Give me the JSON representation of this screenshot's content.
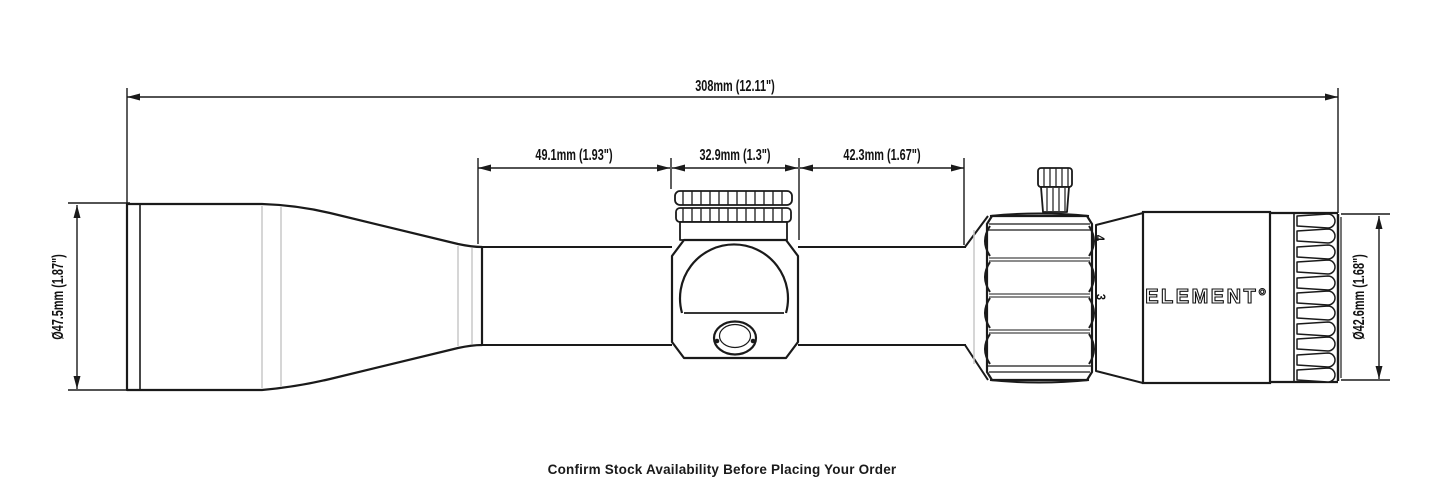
{
  "page": {
    "background": "#ffffff",
    "line_color": "#1a1a1a",
    "accent_gray": "#c8c8c8"
  },
  "dimensions": {
    "overall_length": "308mm (12.11\")",
    "tube_front_section": "49.1mm (1.93\")",
    "saddle_width": "32.9mm (1.3\")",
    "tube_rear_section": "42.3mm (1.67\")",
    "objective_diameter": "Ø47.5mm (1.87\")",
    "ocular_diameter": "Ø42.6mm (1.68\")"
  },
  "scope": {
    "brand": "ELEMENT°",
    "magnification_marks": {
      "upper": "4",
      "lower": "3"
    }
  },
  "footer": {
    "note": "Confirm Stock Availability Before Placing Your Order"
  }
}
